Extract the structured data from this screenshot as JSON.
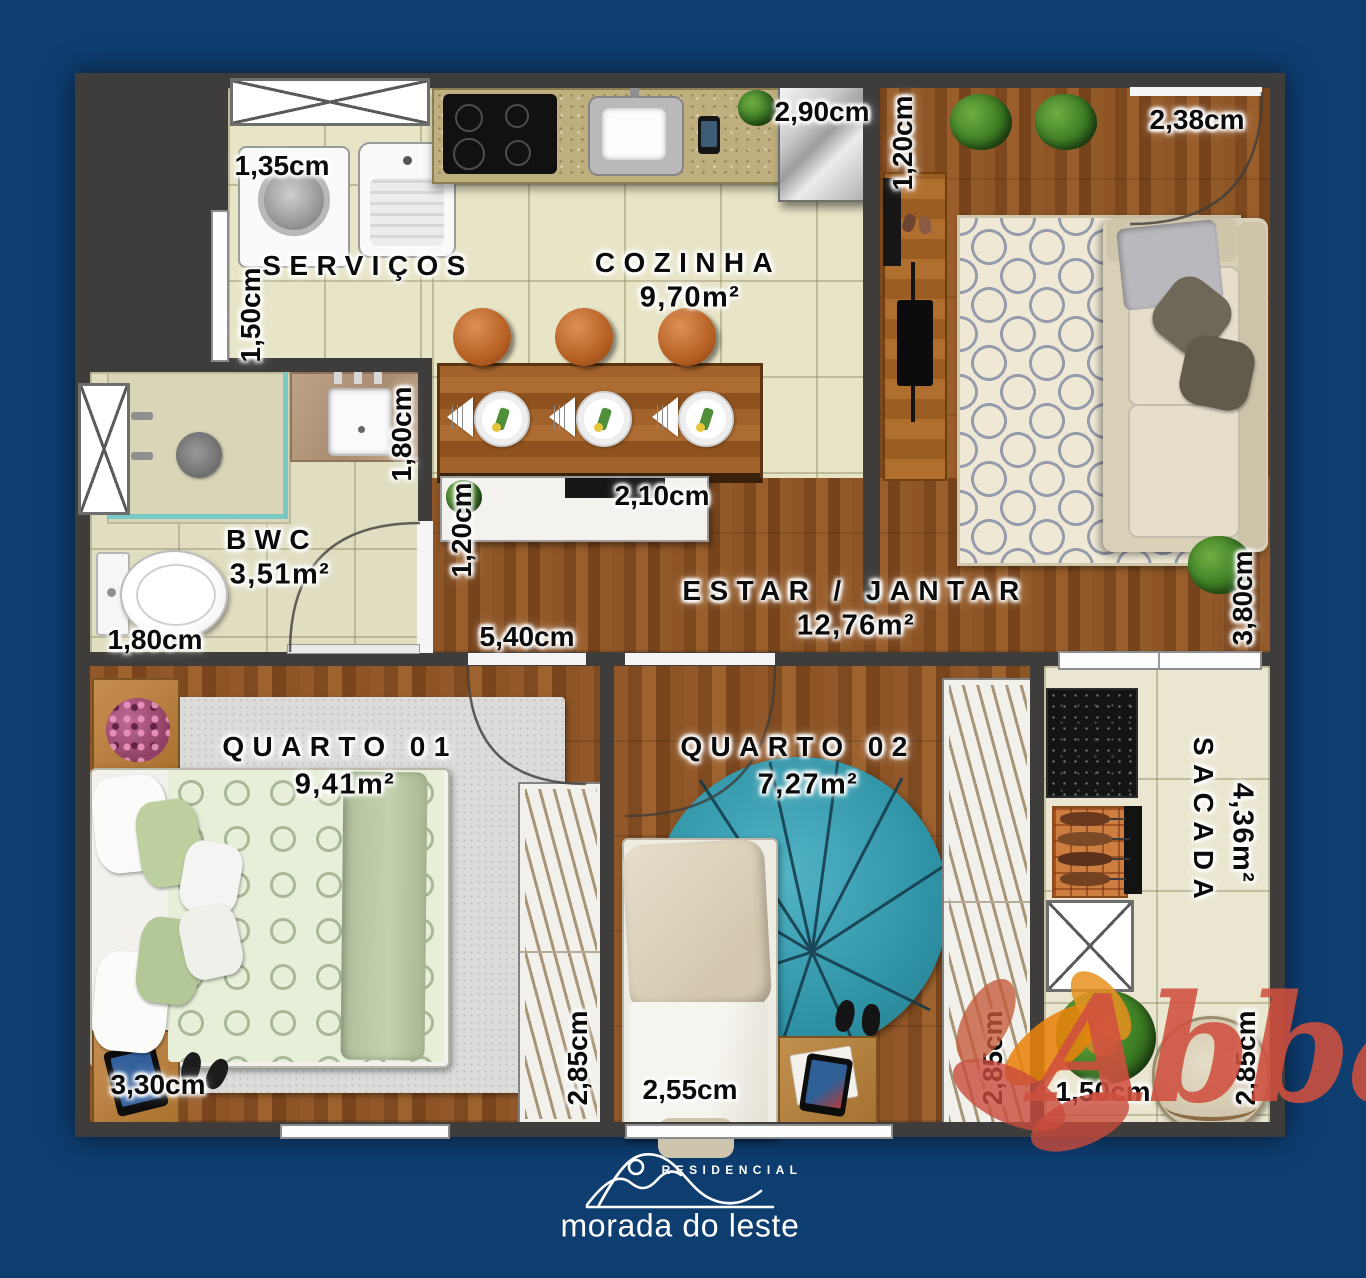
{
  "plan": {
    "rooms": {
      "servicos": {
        "name": "SERVIÇOS"
      },
      "cozinha": {
        "name": "COZINHA",
        "area": "9,70m²"
      },
      "bwc": {
        "name": "BWC",
        "area": "3,51m²"
      },
      "estar_jantar": {
        "name": "ESTAR / JANTAR",
        "area": "12,76m²"
      },
      "quarto_01": {
        "name": "QUARTO 01",
        "area": "9,41m²"
      },
      "quarto_02": {
        "name": "QUARTO 02",
        "area": "7,27m²"
      },
      "sacada": {
        "name": "SACADA",
        "area": "4,36m²"
      }
    },
    "dimensions": {
      "servicos_width": "1,35cm",
      "servicos_depth": "1,50cm",
      "cozinha_width": "2,90cm",
      "hall_width": "1,20cm",
      "entry_door_width": "2,38cm",
      "bwc_counter_depth": "1,80cm",
      "bwc_width": "1,80cm",
      "buffet_depth": "1,20cm",
      "buffet_width": "2,10cm",
      "estar_width": "5,40cm",
      "estar_depth": "3,80cm",
      "quarto01_width": "3,30cm",
      "quarto01_depth": "2,85cm",
      "quarto02_width": "2,55cm",
      "quarto02_depth": "2,85cm",
      "sacada_width": "1,50cm",
      "sacada_depth": "2,85cm"
    }
  },
  "branding": {
    "development_type": "RESIDENCIAL",
    "development_name": "morada do leste",
    "watermark": "Abba"
  },
  "colors": {
    "background": "#0e3d70",
    "wall": "#3f3d3c",
    "tile_floor": "#e8e4c6",
    "wood_floor": "#8a5123",
    "watermark": "#d0503f",
    "logo": "#ffffff"
  }
}
